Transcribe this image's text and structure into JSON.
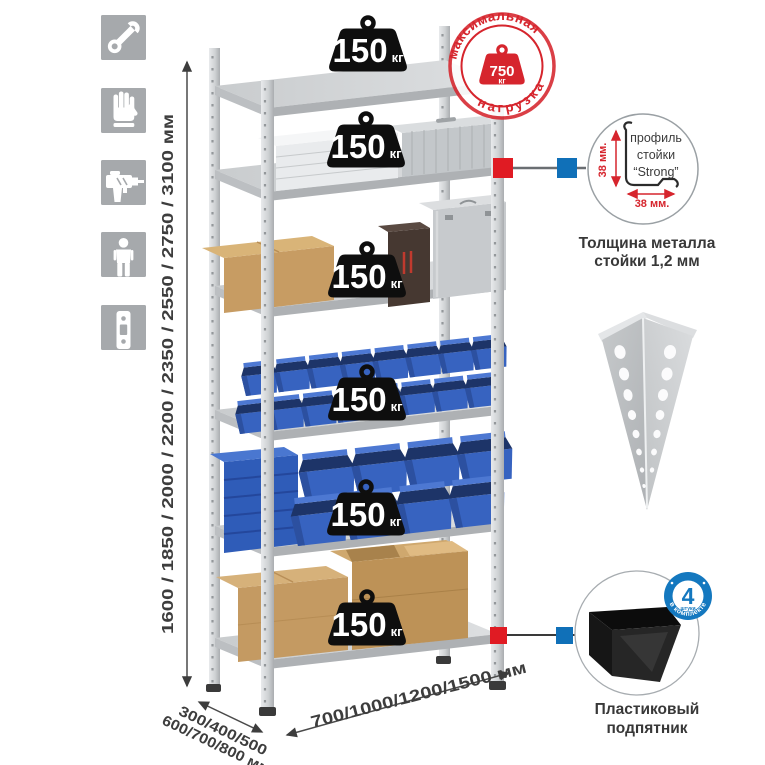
{
  "colors": {
    "stamp_red": "#d6252d",
    "connector_red": "#e01b23",
    "connector_blue": "#1070b8",
    "badge_blue": "#1478bf",
    "bin_blue": "#3763c0",
    "icon_gray": "#a6a9ac",
    "text_dark": "#3d3d3d"
  },
  "left_toolbar": {
    "icons": [
      "wrench",
      "gloves",
      "drill",
      "person",
      "rack-post"
    ]
  },
  "height_dimension": {
    "label": "1600 / 1850 / 2000 / 2200 / 2350 / 2550 / 2750 / 3100 мм"
  },
  "depth_dimension": {
    "line1": "300/400/500",
    "line2": "600/700/800 мм"
  },
  "width_dimension": {
    "label": "700/1000/1200/1500 мм"
  },
  "shelf_badges": [
    {
      "value": "150",
      "unit": "кг"
    },
    {
      "value": "150",
      "unit": "кг"
    },
    {
      "value": "150",
      "unit": "кг"
    },
    {
      "value": "150",
      "unit": "кг"
    },
    {
      "value": "150",
      "unit": "кг"
    },
    {
      "value": "150",
      "unit": "кг"
    }
  ],
  "max_load_stamp": {
    "arc_top": "максимальная",
    "arc_bottom": "нагрузка",
    "value": "750",
    "unit": "кг"
  },
  "profile_detail": {
    "label_line1": "профиль",
    "label_line2": "стойки",
    "label_line3": "“Strong”",
    "vertical_dim": "38 мм.",
    "horizontal_dim": "38 мм.",
    "caption_line1": "Толщина металла",
    "caption_line2": "стойки 1,2 мм"
  },
  "included_badge": {
    "value": "4",
    "small_label": "штуки",
    "arc_label": "в комплекте"
  },
  "foot_detail": {
    "caption_line1": "Пластиковый",
    "caption_line2": "подпятник"
  }
}
